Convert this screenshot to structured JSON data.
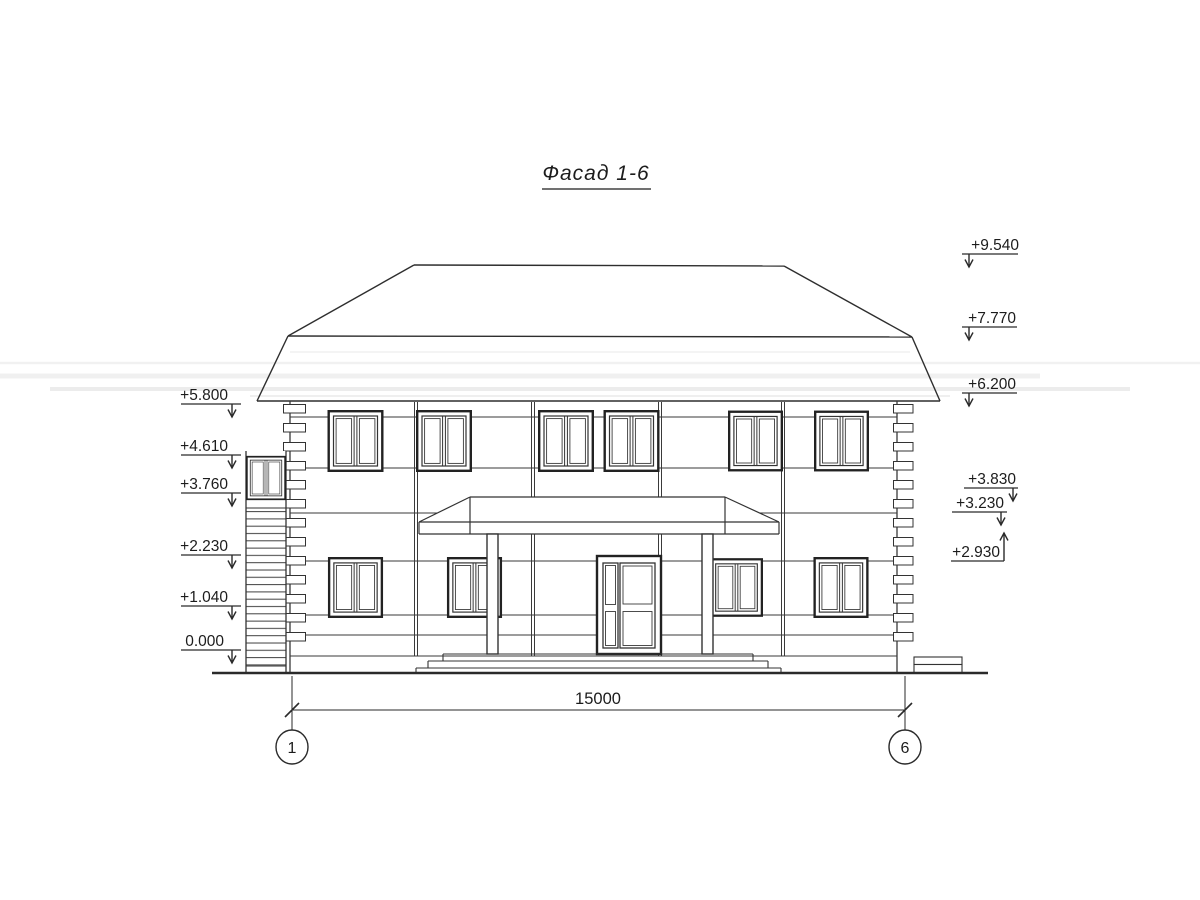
{
  "title": "Фасад 1-6",
  "colors": {
    "line": "#2e2e2e",
    "paper": "#ffffff"
  },
  "elevation_marks": {
    "left": [
      {
        "label": "+5.800"
      },
      {
        "label": "+4.610"
      },
      {
        "label": "+3.760"
      },
      {
        "label": "+2.230"
      },
      {
        "label": "+1.040"
      },
      {
        "label": "0.000"
      }
    ],
    "right": [
      {
        "label": "+9.540"
      },
      {
        "label": "+7.770"
      },
      {
        "label": "+6.200"
      },
      {
        "label": "+3.830"
      },
      {
        "label": "+3.230"
      },
      {
        "label": "+2.930"
      }
    ]
  },
  "dimension": {
    "value": "15000"
  },
  "axes": {
    "left_label": "1",
    "right_label": "6"
  }
}
